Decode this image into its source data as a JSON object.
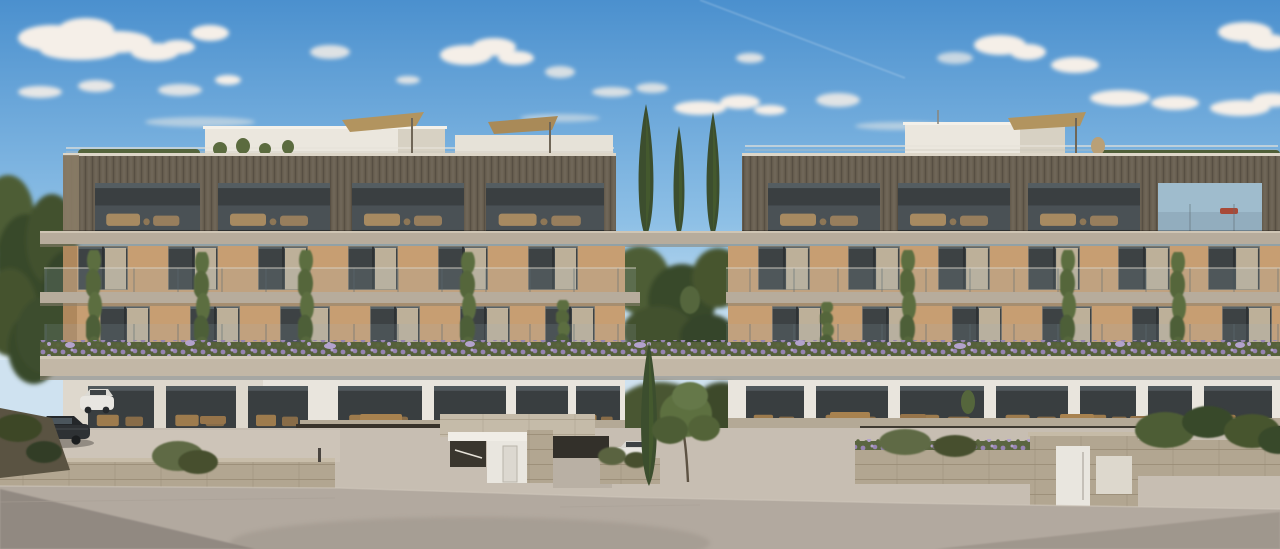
{
  "scene": {
    "title": "Modern residential complex — street elevation render",
    "description": "Architectural rendering of two low-rise luxury apartment blocks with dark bronze penthouse cladding, tan lower floors, glass balconies, hanging vines, lavender planter bands, rooftop umbrellas, cypress trees between the blocks, parked cars and a stone retaining wall along an empty street under a blue sky with scattered clouds.",
    "objects": [
      "sky",
      "clouds",
      "contrail",
      "left apartment block",
      "right apartment block",
      "rooftop penthouses",
      "rooftop umbrellas",
      "rooftop hedge",
      "dark clad top floor",
      "balcony slabs",
      "glass balustrades",
      "hanging vines",
      "lavender planter band",
      "cypress trees",
      "street tree",
      "shrubs",
      "ground floor terraces",
      "garage undercroft",
      "entrance doors",
      "stone retaining walls",
      "dark sedan",
      "white suv",
      "white hatchback",
      "dark car at edge",
      "asphalt road",
      "road shadows"
    ]
  },
  "palette": {
    "sky_top": "#4b90ce",
    "sky_mid": "#8ec0e6",
    "sky_horizon": "#dcebf5",
    "cloud": "#f5efe8",
    "cladding": "#6b6253",
    "cladding_lit": "#8a7c66",
    "cladding_dark": "#4e4739",
    "penthouse": "#ebe7de",
    "penthouse_shade": "#d7d1c3",
    "slab": "#b7ac9c",
    "slab_light": "#c2b7a6",
    "slab_shadow": "#8b8170",
    "wall_tan": "#c79e72",
    "wall_tan_dark": "#a98258",
    "glass": "#3d4244",
    "glass_light": "#72828a",
    "curtain": "#d3c3a8",
    "furniture": "#a8824f",
    "rail_glass": "#9fb7c2",
    "vine": "#5c6e41",
    "tree": "#4d5d36",
    "tree_dark": "#39482b",
    "cypress": "#3c4e2e",
    "lavender": "#9784b2",
    "lavender_light": "#b3a2cc",
    "lavender_leaf": "#5b6640",
    "stone": "#b2a691",
    "stone_line": "#978b74",
    "ground": "#c7beb2",
    "road": "#b2a99f",
    "road_shadow": "#77706a",
    "car_dark": "#2e3134",
    "car_white": "#e8e6e1",
    "umbrella": "#b2945f",
    "door": "#e9e6df",
    "undercroft": "#38322a",
    "sea_view": "#9fbccd",
    "deckchair_red": "#a84a38"
  }
}
